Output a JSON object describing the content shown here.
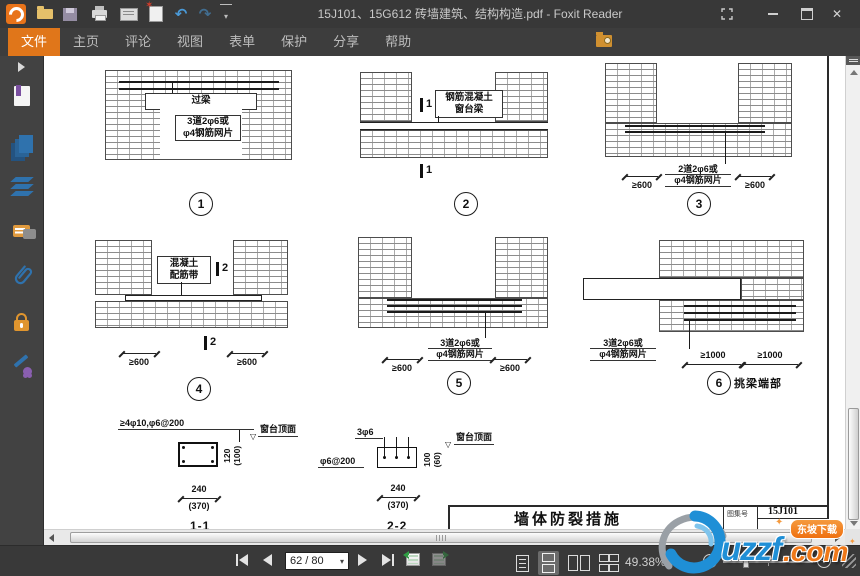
{
  "titlebar": {
    "title": "15J101、15G612 砖墙建筑、结构构造.pdf - Foxit Reader"
  },
  "icons": {
    "undo": "↶",
    "redo": "↷",
    "new_star": "✶",
    "close": "✕",
    "caret_down": "▾",
    "gear": "⚙",
    "find_prev": "◀",
    "find_next": "▶",
    "minus": "−",
    "plus": "+",
    "open_tri": "▽",
    "sparkle": "✦"
  },
  "menubar": {
    "tabs": [
      {
        "label": "文件",
        "active": true
      },
      {
        "label": "主页"
      },
      {
        "label": "评论"
      },
      {
        "label": "视图"
      },
      {
        "label": "表单"
      },
      {
        "label": "保护"
      },
      {
        "label": "分享"
      },
      {
        "label": "帮助"
      }
    ],
    "search_placeholder": "查找"
  },
  "sidebar": {
    "items": [
      "panel-expand",
      "bookmarks",
      "page-thumbnails",
      "layers",
      "comments",
      "attachments",
      "security",
      "digital-signature"
    ]
  },
  "doc": {
    "d1": {
      "lintel": "过梁",
      "note1": "3道2φ6或",
      "note2": "φ4钢筋网片",
      "num": "1"
    },
    "d2": {
      "label1": "钢筋混凝土",
      "label2": "窗台梁",
      "mark": "1",
      "num": "2"
    },
    "d3": {
      "note1": "2道2φ6或",
      "note2": "φ4钢筋网片",
      "dim": "≥600",
      "num": "3"
    },
    "d4": {
      "label1": "混凝土",
      "label2": "配筋带",
      "mark": "2",
      "dim": "≥600",
      "num": "4"
    },
    "d5": {
      "note1": "3道2φ6或",
      "note2": "φ4钢筋网片",
      "dim": "≥600",
      "num": "5"
    },
    "d6": {
      "note1": "3道2φ6或",
      "note2": "φ4钢筋网片",
      "dim": "≥1000",
      "num": "6",
      "caption": "挑梁端部"
    },
    "s11": {
      "rebar": "≥4φ10,φ6@200",
      "surface": "窗台顶面",
      "h": "120",
      "h2": "(100)",
      "w": "240",
      "w2": "(370)",
      "name": "1-1"
    },
    "s22": {
      "rebar_top": "3φ6",
      "rebar_left": "φ6@200",
      "surface": "窗台顶面",
      "h": "100",
      "h2": "(60)",
      "w": "240",
      "w2": "(370)",
      "name": "2-2"
    },
    "titleblock": {
      "title": "墙体防裂措施",
      "atlas_label": "图集号",
      "atlas_no": "15J101"
    }
  },
  "statusbar": {
    "page_display": "62 / 80",
    "zoom_display": "49.38%"
  },
  "watermark": {
    "brand": "uzzf",
    "tld": ".com",
    "badge": "东坡下载"
  }
}
